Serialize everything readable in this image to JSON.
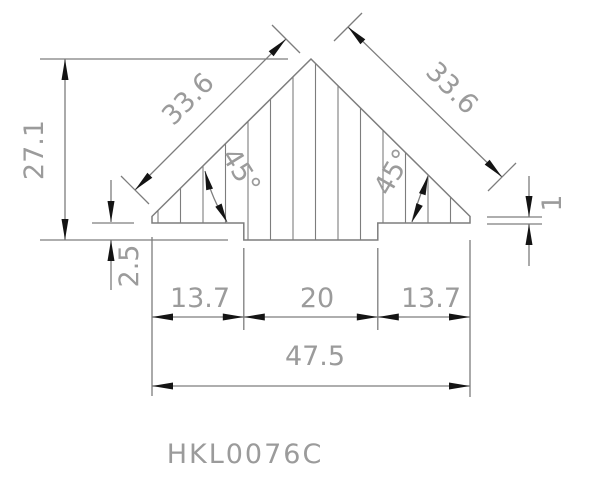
{
  "colors": {
    "line": "#7d7d7d",
    "text": "#9b9b9b",
    "arrow": "#141414",
    "background": "#ffffff"
  },
  "drawing": {
    "part_label": "HKL0076C",
    "dimensions": {
      "slope_left": "33.6",
      "slope_right": "33.6",
      "height": "27.1",
      "step_depth": "2.5",
      "tip_height": "1",
      "bottom_left": "13.7",
      "bottom_center": "20",
      "bottom_right": "13.7",
      "overall_width": "47.5",
      "angle_left": "45°",
      "angle_right": "45°"
    }
  }
}
